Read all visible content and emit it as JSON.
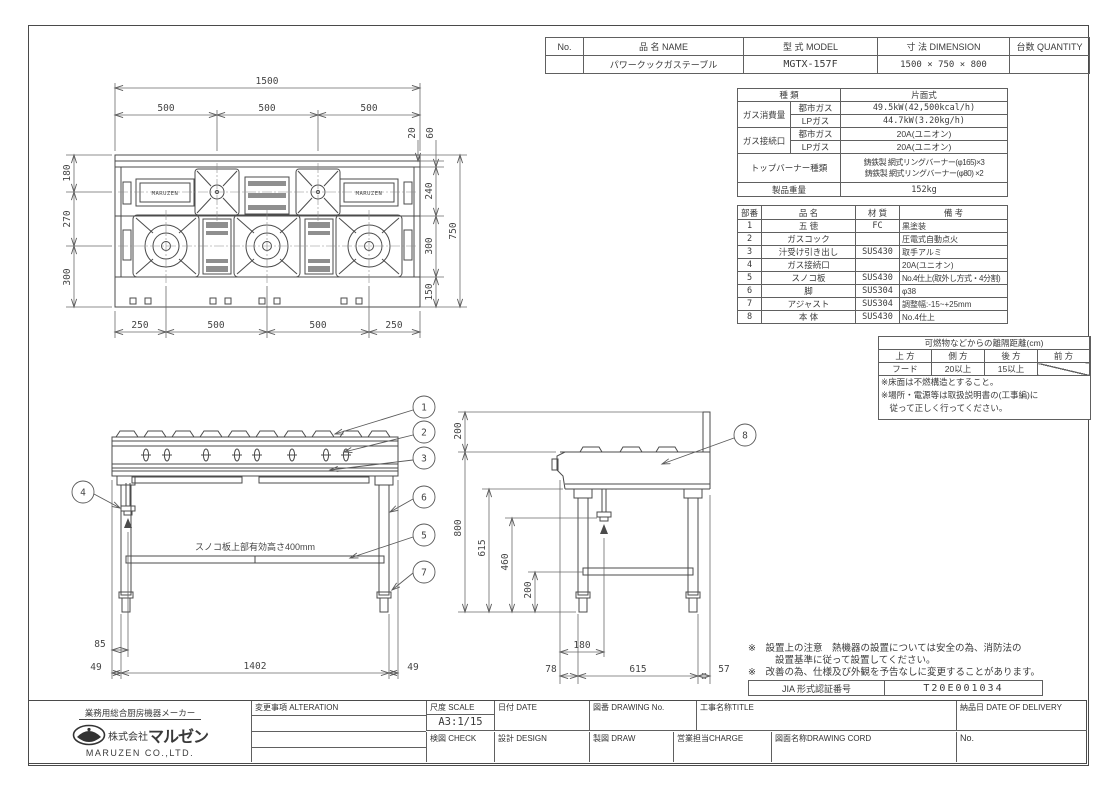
{
  "header_table": {
    "col_no": "No.",
    "col_name": "品 名 NAME",
    "col_model": "型 式 MODEL",
    "col_dimension": "寸 法 DIMENSION",
    "col_quantity": "台数 QUANTITY",
    "row": {
      "name": "パワークックガステーブル",
      "model": "MGTX-157F",
      "dimension": "1500 × 750 × 800"
    }
  },
  "spec_table": {
    "kind_label": "種  類",
    "kind_value": "片面式",
    "consumption_label": "ガス消費量",
    "city_gas": "都市ガス",
    "lp_gas": "LPガス",
    "consumption_city": "49.5kW(42,500kcal/h)",
    "consumption_lp": "44.7kW(3.20kg/h)",
    "connection_label": "ガス接続口",
    "connection_city": "20A(ユニオン)",
    "connection_lp": "20A(ユニオン)",
    "burner_label": "トップバーナー種類",
    "burner_value1": "鋳鉄製 網式リングバーナー(φ165)×3",
    "burner_value2": "鋳鉄製 網式リングバーナー(φ80) ×2",
    "weight_label": "製品重量",
    "weight_value": "152kg"
  },
  "parts_table": {
    "col_no": "部番",
    "col_name": "品  名",
    "col_material": "材 質",
    "col_remarks": "備  考",
    "rows": [
      {
        "no": "1",
        "name": "五 徳",
        "material": "FC",
        "remarks": "黒塗装"
      },
      {
        "no": "2",
        "name": "ガスコック",
        "material": "",
        "remarks": "圧電式自動点火"
      },
      {
        "no": "3",
        "name": "汁受け引き出し",
        "material": "SUS430",
        "remarks": "取手アルミ"
      },
      {
        "no": "4",
        "name": "ガス接続口",
        "material": "",
        "remarks": "20A(ユニオン)"
      },
      {
        "no": "5",
        "name": "スノコ板",
        "material": "SUS430",
        "remarks": "No.4仕上(取外し方式・4分割)"
      },
      {
        "no": "6",
        "name": "脚",
        "material": "SUS304",
        "remarks": "φ38"
      },
      {
        "no": "7",
        "name": "アジャスト",
        "material": "SUS304",
        "remarks": "調整幅:-15~+25mm"
      },
      {
        "no": "8",
        "name": "本 体",
        "material": "SUS430",
        "remarks": "No.4仕上"
      }
    ]
  },
  "clearance": {
    "title": "可燃物などからの離隔距離(cm)",
    "col_top": "上 方",
    "col_side": "側 方",
    "col_back": "後 方",
    "col_front": "前 方",
    "row_label": "フード",
    "val_side": "20以上",
    "val_back": "15以上",
    "note1": "※床面は不燃構造とすること。",
    "note2": "※場所・電源等は取扱説明書の(工事編)に",
    "note3": "　従って正しく行ってください。"
  },
  "footnotes": {
    "line1a": "※　設置上の注意　熱機器の設置については安全の為、消防法の",
    "line1b": "設置基準に従って設置してください。",
    "line2": "※　改善の為、仕様及び外観を予告なしに変更することがあります。",
    "jia_label": "JIA 形式認証番号",
    "jia_value": "T20E001034"
  },
  "title_block": {
    "tagline": "業務用総合厨房機器メーカー",
    "company_prefix": "株式会社",
    "company_jp": "マルゼン",
    "company_en": "MARUZEN CO.,LTD.",
    "alteration_label": "変更事項 ALTERATION",
    "scale_label": "尺度 SCALE",
    "scale_value": "A3:1/15",
    "date_label": "日付 DATE",
    "drawing_no_label": "図番 DRAWING No.",
    "title_label": "工事名称TITLE",
    "delivery_label": "納品日  DATE OF DELIVERY",
    "check_label": "検図 CHECK",
    "design_label": "設計 DESIGN",
    "draw_label": "製図 DRAW",
    "charge_label": "営業担当CHARGE",
    "drawing_name_label": "図面名称DRAWING CORD",
    "no_label": "No."
  },
  "plan_view": {
    "brand": "MARUZEN",
    "total_width": "1500",
    "pitch": "500",
    "trim": "20",
    "back": "60",
    "row1": "240",
    "row2": "300",
    "front": "150",
    "depth": "750",
    "left1": "180",
    "left2": "270",
    "left3": "300",
    "edge": "250"
  },
  "front_view": {
    "note": "スノコ板上部有効高さ400mm",
    "pipe_offset": "85",
    "leg_inset": "49",
    "leg_span": "1402"
  },
  "side_view": {
    "splash": "200",
    "height": "800",
    "under": "615",
    "gas_h": "460",
    "shelf_h": "200",
    "pipe_offset": "180",
    "front_inset": "78",
    "leg_span": "615",
    "back_inset": "57"
  },
  "balloons": {
    "b1": "1",
    "b2": "2",
    "b3": "3",
    "b4": "4",
    "b5": "5",
    "b6": "6",
    "b7": "7",
    "b8": "8"
  }
}
